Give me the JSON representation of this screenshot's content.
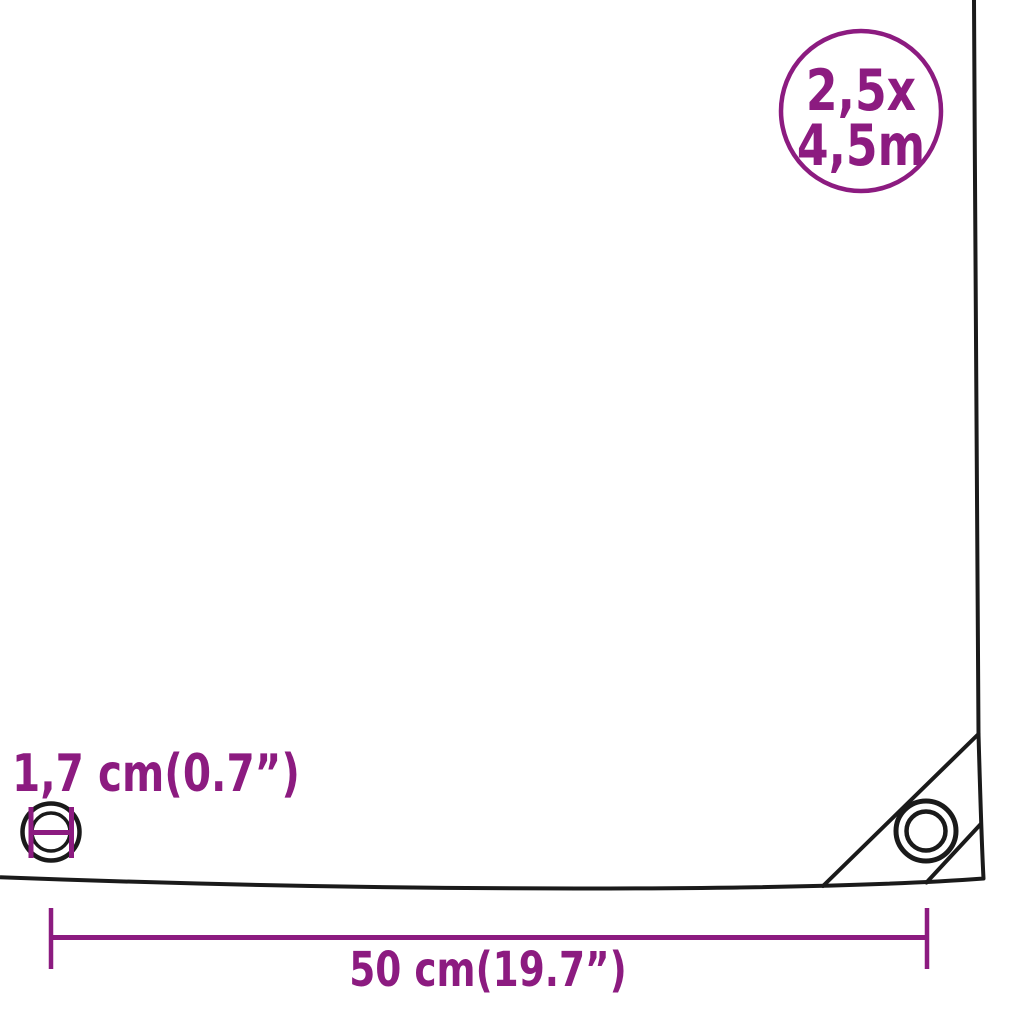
{
  "colors": {
    "accent": "#8C1B80",
    "line": "#1A1A1A",
    "background": "#FFFFFF"
  },
  "size_badge": {
    "width_label": "2,5x",
    "length_label": "4,5m"
  },
  "eyelet": {
    "diameter_label": "1,7 cm(0.7”)"
  },
  "grommet_spacing": {
    "label": "50 cm(19.7”)"
  }
}
